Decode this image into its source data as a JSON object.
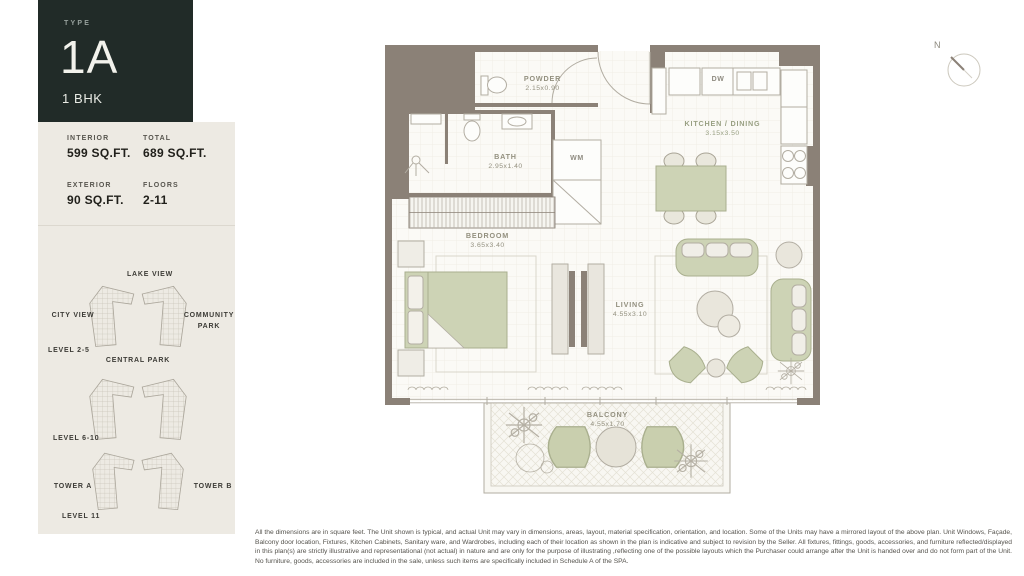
{
  "panel": {
    "type_label": "TYPE",
    "unit_type": "1A",
    "unit_config": "1 BHK",
    "specs": [
      {
        "label": "INTERIOR",
        "value": "599 SQ.FT."
      },
      {
        "label": "TOTAL",
        "value": "689 SQ.FT."
      },
      {
        "label": "EXTERIOR",
        "value": "90 SQ.FT."
      },
      {
        "label": "FLOORS",
        "value": "2-11"
      }
    ],
    "keyplans": [
      {
        "level": "LEVEL 2-5",
        "top": "LAKE VIEW",
        "left": "CITY VIEW",
        "right": "COMMUNITY PARK",
        "bottom": "CENTRAL PARK"
      },
      {
        "level": "LEVEL 6-10"
      },
      {
        "level": "LEVEL 11",
        "tower_a": "TOWER A",
        "tower_b": "TOWER B"
      }
    ]
  },
  "plan": {
    "compass": "N",
    "rooms": {
      "powder": {
        "name": "POWDER",
        "dims": "2.15x0.90"
      },
      "bath": {
        "name": "BATH",
        "dims": "2.95x1.40"
      },
      "kitchen": {
        "name": "KITCHEN / DINING",
        "dims": "3.15x3.50"
      },
      "bedroom": {
        "name": "BEDROOM",
        "dims": "3.65x3.40"
      },
      "living": {
        "name": "LIVING",
        "dims": "4.55x3.10"
      },
      "balcony": {
        "name": "BALCONY",
        "dims": "4.55x1.70"
      }
    },
    "appliances": {
      "wm": "WM",
      "dw": "DW"
    }
  },
  "disclaimer": "All the dimensions are in square feet. The Unit shown is typical, and actual Unit may vary in dimensions, areas, layout, material specification, orientation, and location. Some of the Units may have a mirrored layout of the above plan. Unit Windows, Façade, Balcony door location, Fixtures, Kitchen Cabinets, Sanitary ware, and Wardrobes, including each of their location as shown in the plan is indicative and subject to revision by the Seller. All fixtures, fittings, goods, accessories, and furniture reflected/displayed in this plan(s) are strictly illustrative and representational (not actual) in nature and are only for the purpose of illustrating ,reflecting one of the possible layouts which the Purchaser could arrange after the Unit is handed over and do not form part of the Unit. No furniture, goods, accessories are included in the sale, unless such items are specifically included in Schedule A of the SPA.",
  "colors": {
    "accent_dark": "#212b28",
    "panel_bg": "#edeae3",
    "wall_taupe": "#8b8177",
    "furniture_green": "#cdd3b5",
    "floor": "#fbfaf6"
  }
}
